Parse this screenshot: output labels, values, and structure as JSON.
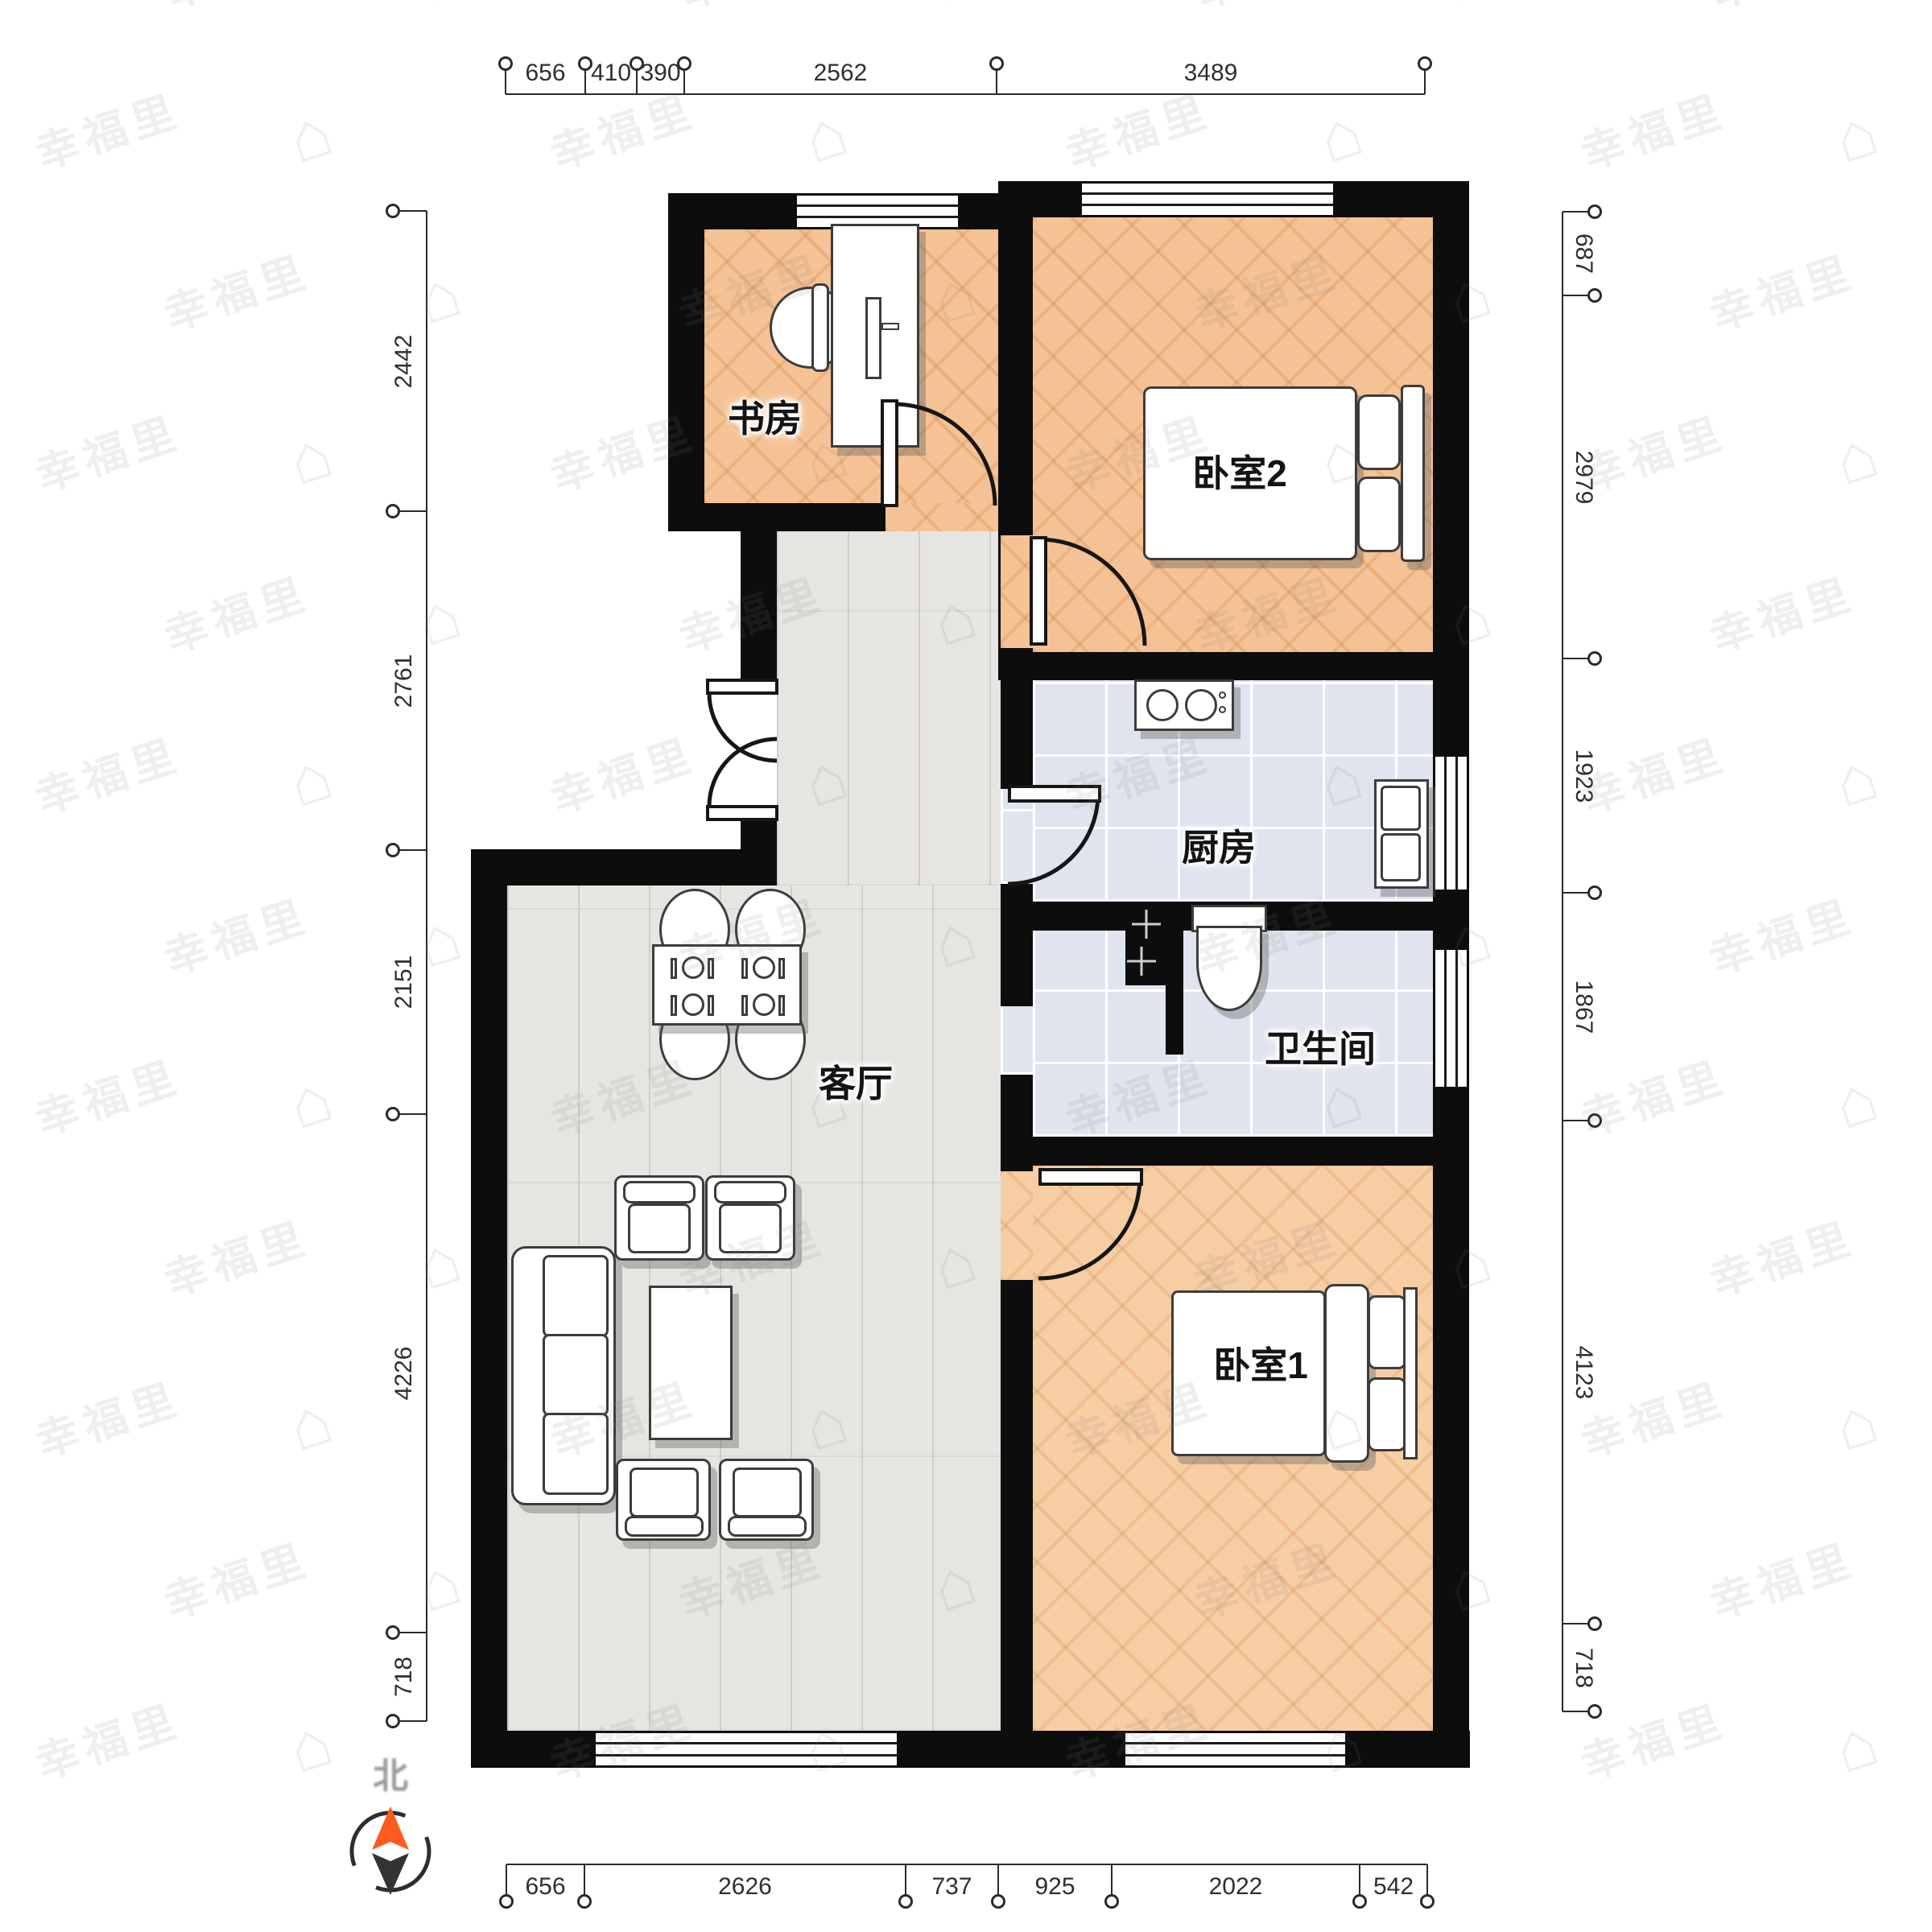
{
  "watermark": {
    "text": "幸福里",
    "icon": "⌂"
  },
  "compass": {
    "label": "北"
  },
  "rooms": {
    "study": {
      "label": "书房"
    },
    "bedroom2": {
      "label": "卧室2"
    },
    "kitchen": {
      "label": "厨房"
    },
    "bathroom": {
      "label": "卫生间"
    },
    "living": {
      "label": "客厅"
    },
    "bedroom1": {
      "label": "卧室1"
    }
  },
  "dimensions": {
    "top": {
      "labels": [
        "656",
        "410",
        "390",
        "2562",
        "3489"
      ]
    },
    "bottom": {
      "labels": [
        "656",
        "2626",
        "737",
        "925",
        "2022",
        "542"
      ]
    },
    "left": {
      "labels": [
        "2442",
        "2761",
        "2151",
        "4226",
        "718"
      ]
    },
    "right": {
      "labels": [
        "687",
        "2979",
        "1923",
        "1867",
        "4123",
        "718"
      ]
    }
  },
  "colors": {
    "wall": "#0d0d0d",
    "wood_floor": "#f5c295",
    "gray_floor": "#e7e5e1",
    "tile_floor": "#dfe4ee",
    "compass_needle": "#ff5a1f"
  }
}
